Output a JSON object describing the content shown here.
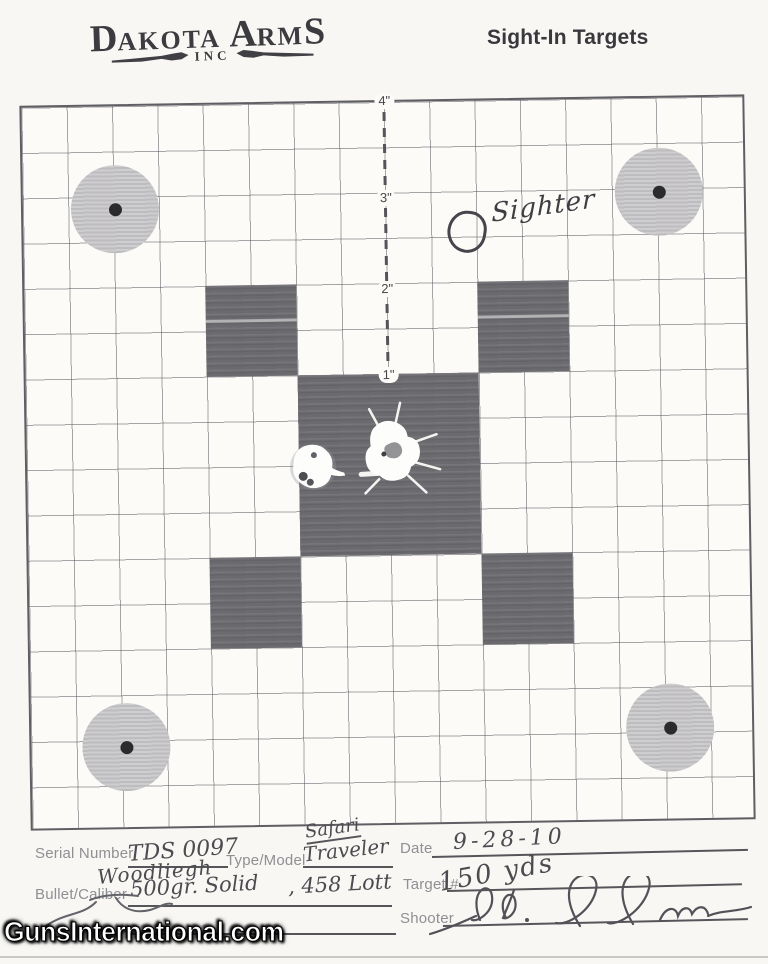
{
  "header": {
    "logo": {
      "part_d": "D",
      "part_akota": "AKOTA",
      "part_a": "A",
      "part_rm": "RM",
      "part_s": "S",
      "inc": "INC"
    },
    "title": "Sight-In Targets"
  },
  "target": {
    "ruler_labels": [
      "4\"",
      "3\"",
      "2\"",
      "1\""
    ],
    "sighter_label": "Sighter"
  },
  "form": {
    "serial_label": "Serial Number",
    "serial_value": "TDS 0097",
    "type_label": "Type/Model",
    "type_value_line1": "Safari",
    "type_value_line2": "Traveler",
    "date_label": "Date",
    "date_value": "9-28-10",
    "bullet_label": "Bullet/Caliber",
    "bullet_brand": "Woodliegh",
    "bullet_weight": "500gr. Solid",
    "bullet_caliber": ", 458 Lott",
    "target_number_label": "Target #",
    "target_number_value": "150 yds",
    "shooter_label": "Shooter"
  },
  "watermark": {
    "text": "GunsInternational.com"
  },
  "colors": {
    "paper": "#f8f7f4",
    "grid_line": "#5c5c62",
    "dark_square": "#6a6a6f",
    "bull_circle": "#c7c6c8",
    "handwriting": "#4b4b50"
  }
}
